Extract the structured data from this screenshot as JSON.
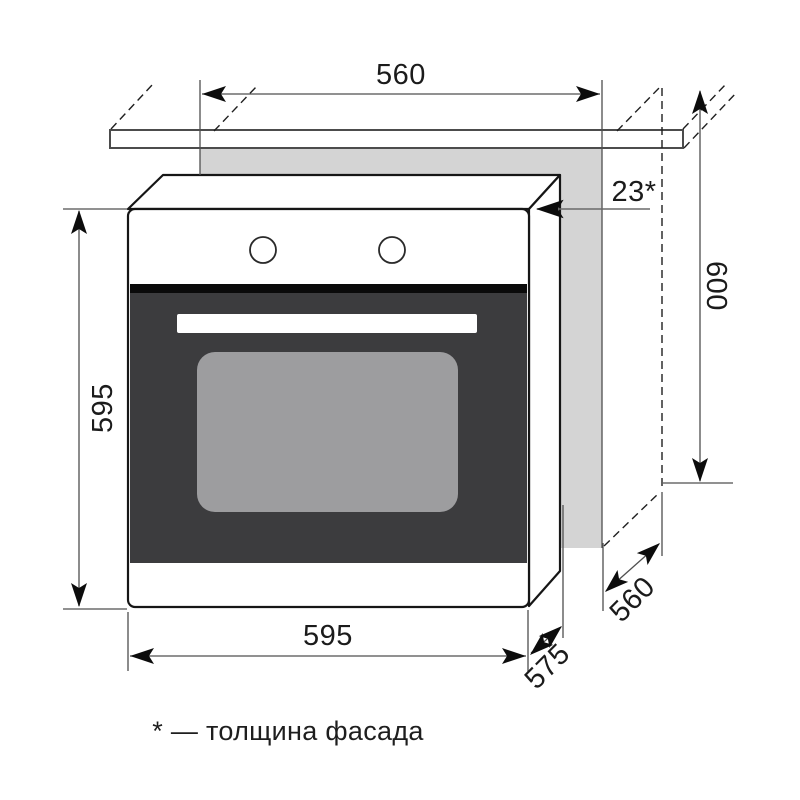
{
  "diagram": {
    "title": "built-in oven installation dimensions",
    "labels": {
      "niche_width": "560",
      "appliance_height": "595",
      "niche_height": "600",
      "facade_thickness": "23*",
      "appliance_width": "595",
      "niche_depth": "560",
      "appliance_depth": "575"
    },
    "footnote": "* — толщина фасада",
    "colors": {
      "background": "#ffffff",
      "niche_fill": "#d4d4d4",
      "door_fill": "#3c3c3e",
      "window_fill": "#9d9d9f",
      "outline": "#161616",
      "dimension_line": "#4f4f4f"
    }
  }
}
